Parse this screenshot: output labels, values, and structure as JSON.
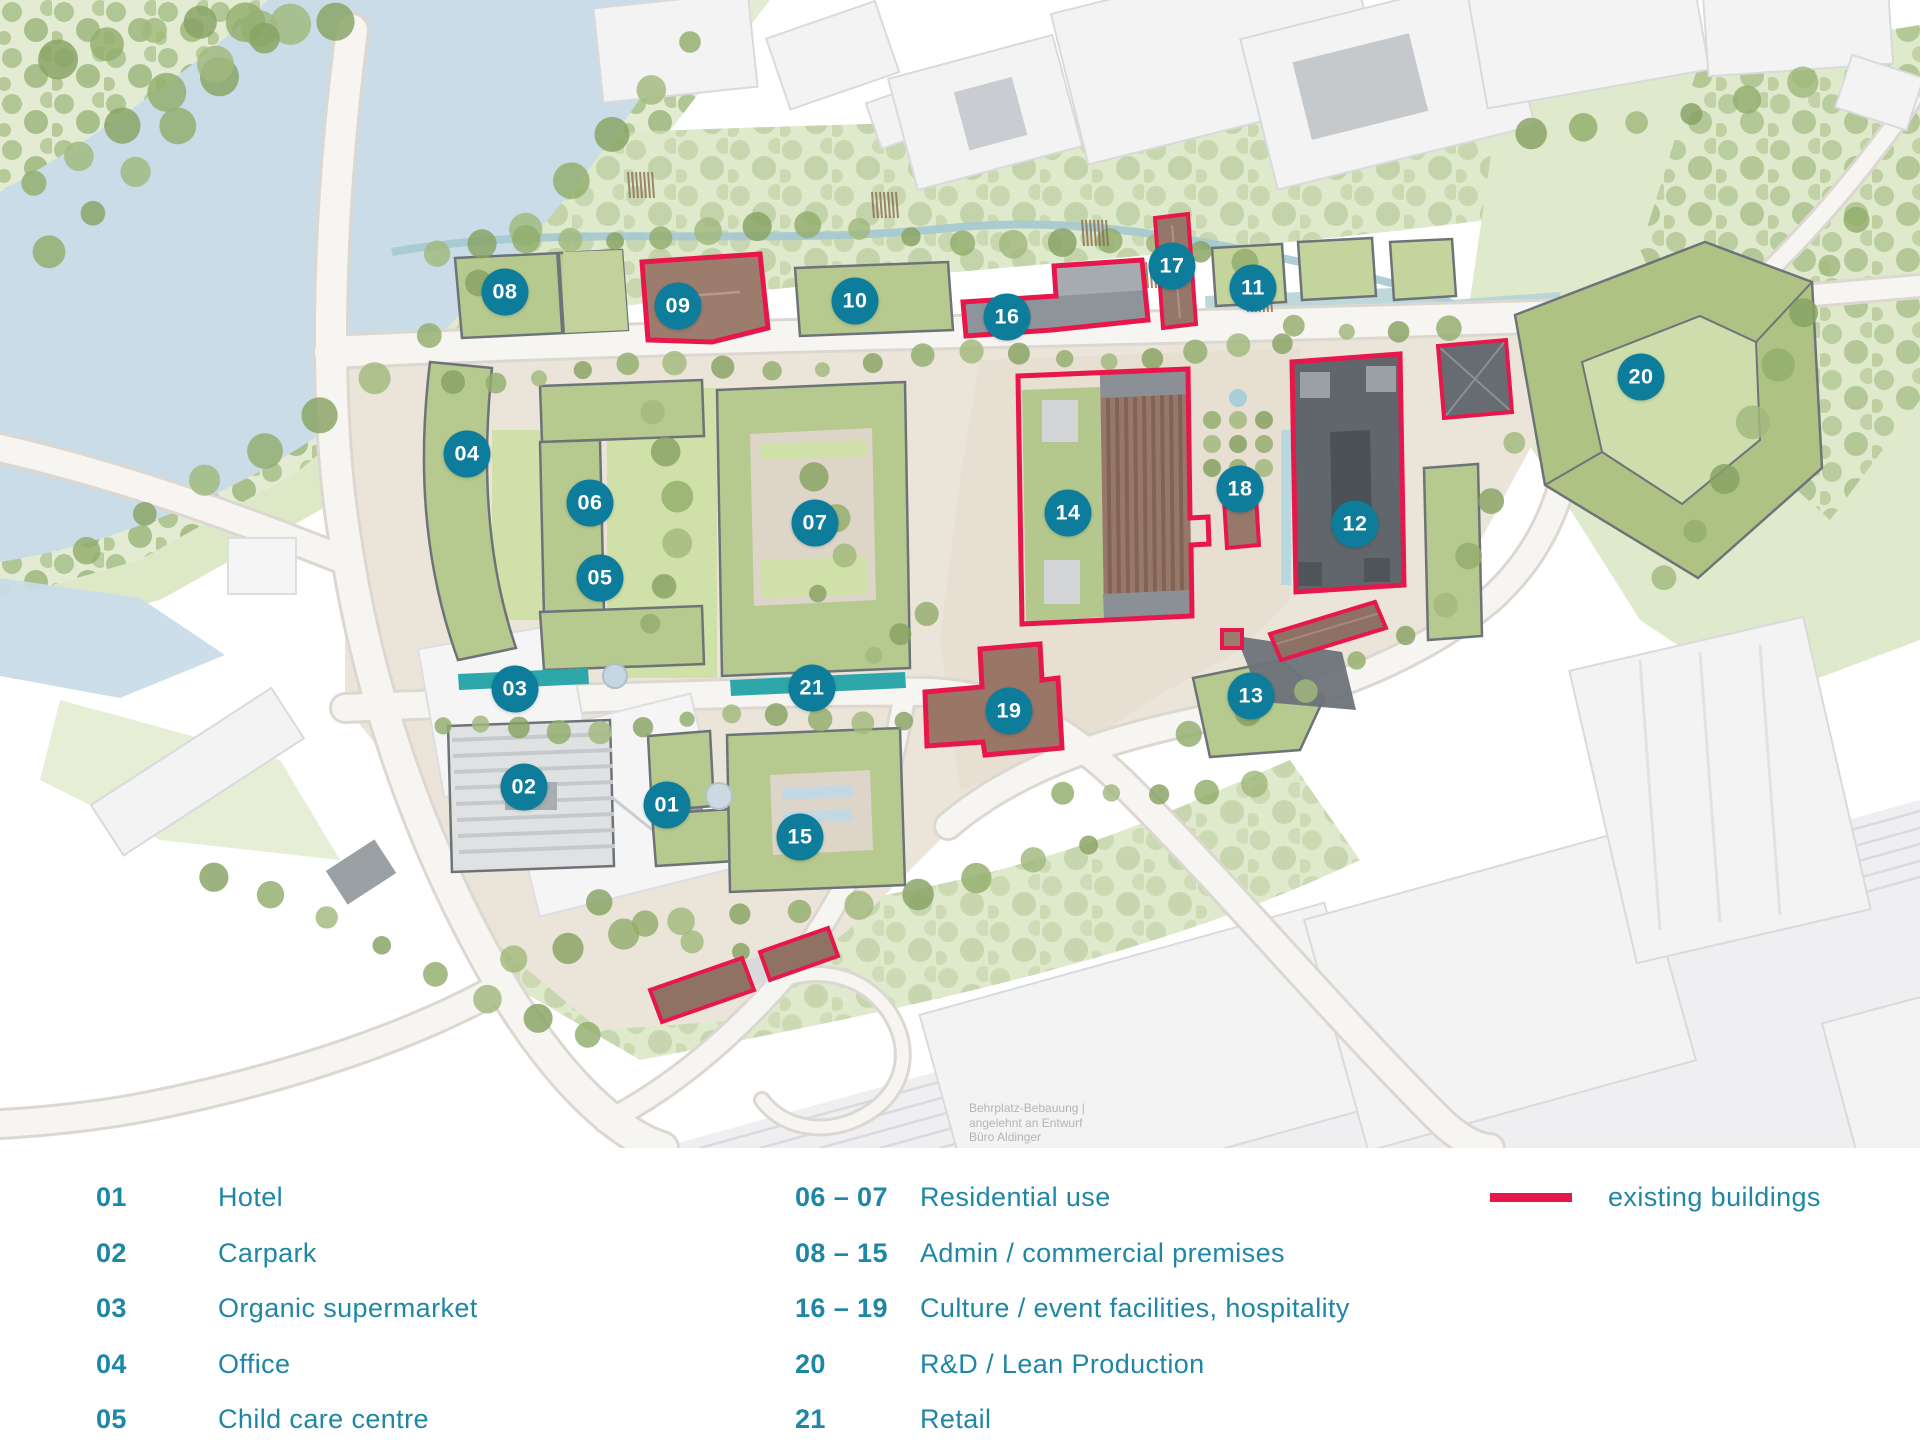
{
  "colors": {
    "marker_bg": "#0e7d9c",
    "legend_text": "#1f87a6",
    "existing_red": "#e8174b",
    "retail_strip_teal": "#2ea7ab"
  },
  "map": {
    "markers": [
      {
        "label": "01",
        "x": 667,
        "y": 805
      },
      {
        "label": "02",
        "x": 524,
        "y": 787
      },
      {
        "label": "03",
        "x": 515,
        "y": 689
      },
      {
        "label": "04",
        "x": 467,
        "y": 454
      },
      {
        "label": "05",
        "x": 600,
        "y": 578
      },
      {
        "label": "06",
        "x": 590,
        "y": 503
      },
      {
        "label": "07",
        "x": 815,
        "y": 523
      },
      {
        "label": "08",
        "x": 505,
        "y": 292
      },
      {
        "label": "09",
        "x": 678,
        "y": 306
      },
      {
        "label": "10",
        "x": 855,
        "y": 301
      },
      {
        "label": "11",
        "x": 1253,
        "y": 288
      },
      {
        "label": "12",
        "x": 1355,
        "y": 524
      },
      {
        "label": "13",
        "x": 1251,
        "y": 696
      },
      {
        "label": "14",
        "x": 1068,
        "y": 513
      },
      {
        "label": "15",
        "x": 800,
        "y": 837
      },
      {
        "label": "16",
        "x": 1007,
        "y": 317
      },
      {
        "label": "17",
        "x": 1172,
        "y": 266
      },
      {
        "label": "18",
        "x": 1240,
        "y": 489
      },
      {
        "label": "19",
        "x": 1009,
        "y": 711
      },
      {
        "label": "20",
        "x": 1641,
        "y": 377
      },
      {
        "label": "21",
        "x": 812,
        "y": 688
      }
    ],
    "attribution": {
      "line1": "Behrplatz-Bebauung |",
      "line2": "angelehnt an Entwurf",
      "line3": "Büro Aldinger"
    }
  },
  "legend": {
    "columns": [
      {
        "items": [
          {
            "num": "01",
            "label": "Hotel"
          },
          {
            "num": "02",
            "label": "Carpark"
          },
          {
            "num": "03",
            "label": "Organic supermarket"
          },
          {
            "num": "04",
            "label": "Office"
          },
          {
            "num": "05",
            "label": "Child care centre"
          }
        ]
      },
      {
        "items": [
          {
            "num": "06 – 07",
            "label": "Residential use"
          },
          {
            "num": "08 – 15",
            "label": "Admin / commercial premises"
          },
          {
            "num": "16 – 19",
            "label": "Culture / event facilities, hospitality"
          },
          {
            "num": "20",
            "label": "R&D / Lean Production"
          },
          {
            "num": "21",
            "label": "Retail"
          }
        ]
      }
    ],
    "existing_label": "existing buildings"
  }
}
